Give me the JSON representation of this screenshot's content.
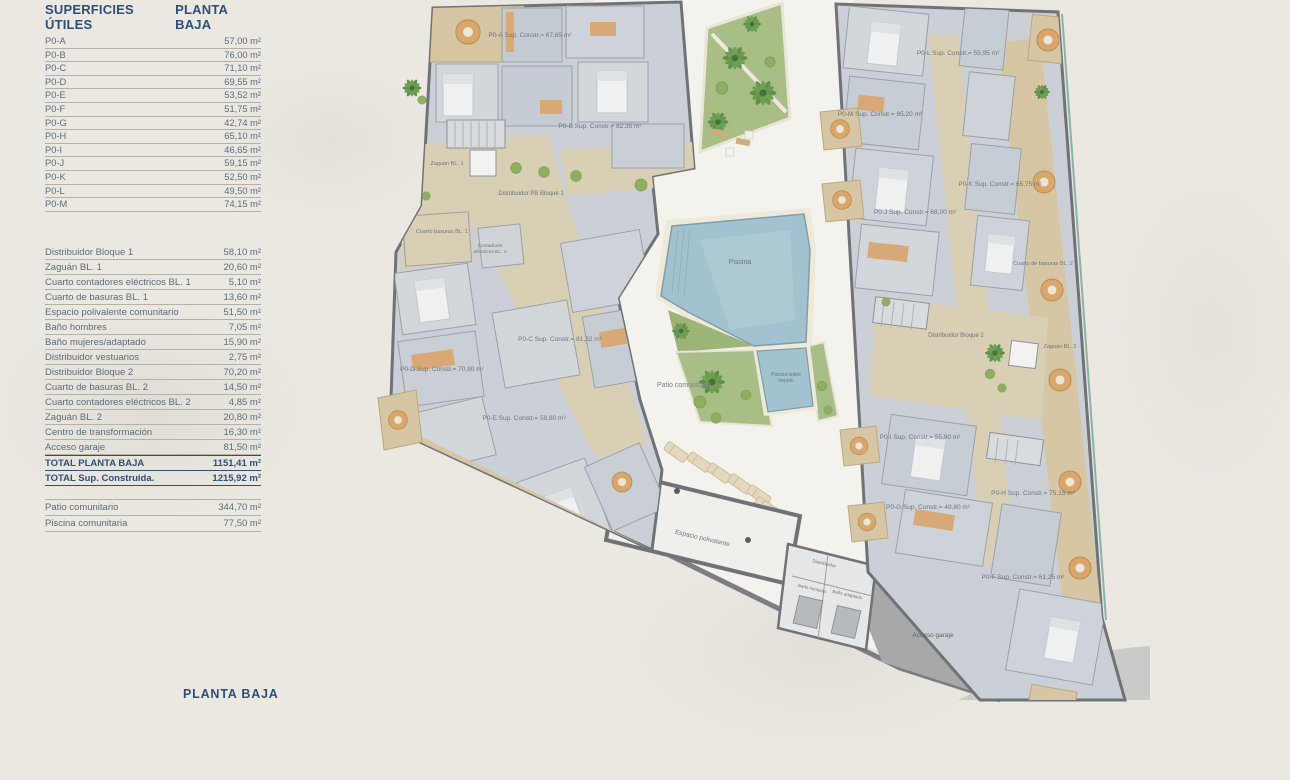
{
  "table": {
    "title": "SUPERFICIES ÚTILES",
    "subtitle": "PLANTA BAJA",
    "units": [
      {
        "label": "P0-A",
        "value": "57,00 m²"
      },
      {
        "label": "P0-B",
        "value": "76,00 m²"
      },
      {
        "label": "P0-C",
        "value": "71,10 m²"
      },
      {
        "label": "P0-D",
        "value": "69,55 m²"
      },
      {
        "label": "P0-E",
        "value": "53,52 m²"
      },
      {
        "label": "P0-F",
        "value": "51,75 m²"
      },
      {
        "label": "P0-G",
        "value": "42,74 m²"
      },
      {
        "label": "P0-H",
        "value": "65,10 m²"
      },
      {
        "label": "P0-I",
        "value": "46,65 m²"
      },
      {
        "label": "P0-J",
        "value": "59,15 m²"
      },
      {
        "label": "P0-K",
        "value": "52,50 m²"
      },
      {
        "label": "P0-L",
        "value": "49,50 m²"
      },
      {
        "label": "P0-M",
        "value": "74,15 m²"
      }
    ],
    "commons": [
      {
        "label": "Distribuidor Bloque 1",
        "value": "58,10 m²"
      },
      {
        "label": "Zaguán BL. 1",
        "value": "20,60 m²"
      },
      {
        "label": "Cuarto contadores eléctricos BL. 1",
        "value": "5,10 m²"
      },
      {
        "label": "Cuarto de basuras BL. 1",
        "value": "13,60 m²"
      },
      {
        "label": "Espacio polivalente comunitario",
        "value": "51,50 m²"
      },
      {
        "label": "Baño hombres",
        "value": "7,05 m²"
      },
      {
        "label": "Baño mujeres/adaptado",
        "value": "15,90 m²"
      },
      {
        "label": "Distribuidor vestuarios",
        "value": "2,75 m²"
      },
      {
        "label": "Distribuidor Bloque 2",
        "value": "70,20 m²"
      },
      {
        "label": "Cuarto de basuras BL. 2",
        "value": "14,50 m²"
      },
      {
        "label": "Cuarto contadores eléctricos BL. 2",
        "value": "4,85 m²"
      },
      {
        "label": "Zaguán BL. 2",
        "value": "20,80 m²"
      },
      {
        "label": "Centro de transformación",
        "value": "16,30 m²"
      },
      {
        "label": "Acceso garaje",
        "value": "81,50 m²"
      }
    ],
    "totals": [
      {
        "label": "TOTAL PLANTA BAJA",
        "value": "1151,41 m²"
      },
      {
        "label": "TOTAL Sup. Construida.",
        "value": "1215,92 m²"
      }
    ],
    "outdoor": [
      {
        "label": "Patio comunitario",
        "value": "344,70 m²"
      },
      {
        "label": "Piscina comunitaria",
        "value": "77,50 m²"
      }
    ]
  },
  "footer": {
    "title": "PLANTA BAJA"
  },
  "plan": {
    "labels": {
      "p0a": "P0-A Sup. Constr.= 67,65 m²",
      "p0b": "P0-B Sup. Constr.= 82,35 m²",
      "p0c": "P0-C Sup. Constr.= 81,32 m²",
      "p0d": "P0-D Sup. Constr.= 70,90 m²",
      "p0e": "P0-E Sup. Constr.= 59,80 m²",
      "p0f": "P0-F Sup. Constr.= 61,25 m²",
      "p0g": "P0-G Sup. Constr.= 49,80 m²",
      "p0h": "P0-H Sup. Constr.= 75,15 m²",
      "p0i": "P0-I Sup. Constr.= 55,90 m²",
      "p0j": "P0-J Sup. Constr.= 68,00 m²",
      "p0k": "P0-K Sup. Constr.= 65,75 m²",
      "p0l": "P0-L Sup. Constr.= 55,95 m²",
      "p0m": "P0-M Sup. Constr.= 85,20 m²",
      "zaguan1": "Zaguán BL. 1",
      "distribuidor1": "Distribuidor PB Bloque 1",
      "basuras1": "Cuarto basuras BL. 1",
      "contadores1_l1": "Contadores",
      "contadores1_l2": "eléctricos BL. 1",
      "distribuidor2": "Distribuidor Bloque 2",
      "zaguan2": "Zaguán BL. 2",
      "basuras2": "Cuarto de basuras BL. 2",
      "patio": "Patio comunitario",
      "piscina": "Piscina",
      "piscina_forjado_l1": "Piscina sobre",
      "piscina_forjado_l2": "forjado",
      "espacio": "Espacio polivalente",
      "distribuidor_v": "Distribuidor",
      "bano_hombres": "Baño hombres",
      "bano_adaptado": "Baño adaptado",
      "acceso": "Acceso garaje"
    },
    "colors": {
      "accent_blue": "#2d4f78",
      "pool": "#a3c2cf",
      "garden": "#a9bd87",
      "corridor_beige": "#d9cfb5",
      "terrace_tan": "#d6c6a3",
      "apartment_gray": "#cbd0d6",
      "wall": "#6f7377",
      "garage": "#a8a8a8",
      "boundary_teal": "#8ab3a6"
    }
  }
}
